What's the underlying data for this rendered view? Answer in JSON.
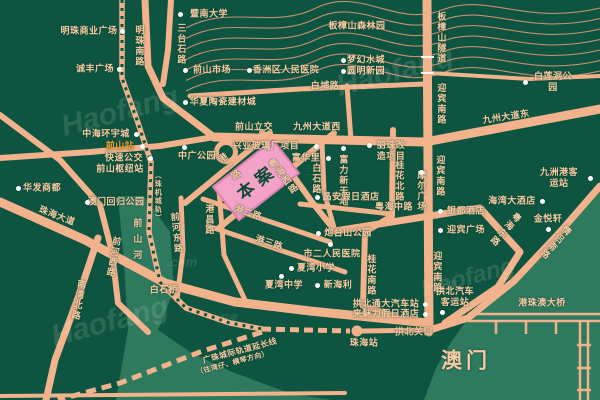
{
  "map": {
    "type": "real-estate-location-map",
    "project_label": "本案",
    "colors": {
      "background": "#0D5540",
      "water": "#2E7A5F",
      "road": "#F2B28C",
      "contour": "#E6987A",
      "label_text": "#F8CBA4",
      "poi_dot": "#FFFFFF",
      "project_pink": "#F3A3C7",
      "station_orange": "#F5A02A"
    },
    "pois": [
      {
        "t": "暨南大学",
        "x": 209,
        "y": 14,
        "d": [
          180,
          14
        ]
      },
      {
        "t": "明珠商业广场",
        "x": 89,
        "y": 31,
        "d": [
          122,
          31
        ]
      },
      {
        "t": "诚丰广场",
        "x": 95,
        "y": 69,
        "d": [
          119,
          69
        ]
      },
      {
        "t": "前山市场",
        "x": 212,
        "y": 70,
        "d": [
          185,
          70
        ]
      },
      {
        "t": "香洲区人民医院",
        "x": 286,
        "y": 70,
        "d": [
          249,
          70
        ]
      },
      {
        "t": "梦幻水城",
        "x": 366,
        "y": 60,
        "d": [
          343,
          60
        ]
      },
      {
        "t": "圆明新园",
        "x": 366,
        "y": 71,
        "d": [
          343,
          71
        ]
      },
      {
        "t": "白莲洞公园",
        "x": 553,
        "y": 82,
        "d": [
          525,
          82
        ]
      },
      {
        "t": "华夏陶瓷建材城",
        "x": 223,
        "y": 102,
        "d": [
          185,
          102
        ]
      },
      {
        "t": "中海环宇城",
        "x": 106,
        "y": 134,
        "d": [
          136,
          134
        ]
      },
      {
        "t": "前山站",
        "x": 120,
        "y": 146,
        "d": [
          142,
          146
        ],
        "c": "#F5A02A"
      },
      {
        "t": "快速公交",
        "x": 124,
        "y": 158,
        "d": [
          150,
          158
        ]
      },
      {
        "t": "前山枢纽站",
        "x": 120,
        "y": 169
      },
      {
        "t": "中广公园",
        "x": 197,
        "y": 156,
        "d": [
          184,
          147
        ]
      },
      {
        "t": "华发商都",
        "x": 42,
        "y": 188,
        "d": [
          18,
          188
        ]
      },
      {
        "t": "澳门回归公园",
        "x": 116,
        "y": 202,
        "d": [
          87,
          202
        ]
      },
      {
        "t": "兴业玻璃厂项目",
        "x": 266,
        "y": 146,
        "d": [
          316,
          146
        ]
      },
      {
        "t": "富华里",
        "x": 306,
        "y": 158,
        "d": [
          328,
          158
        ]
      },
      {
        "t": "富力新天地",
        "x": 343,
        "y": 181,
        "d": [
          343,
          148
        ],
        "v": 1
      },
      {
        "t": "丽珠改\n造项目",
        "x": 391,
        "y": 151,
        "d": [
          369,
          145
        ]
      },
      {
        "t": "晶安假日酒店",
        "x": 351,
        "y": 197,
        "d": [
          317,
          197
        ]
      },
      {
        "t": "摩尔广场",
        "x": 421,
        "y": 191,
        "d": [
          421,
          172
        ],
        "v": 1
      },
      {
        "t": "九洲港客运站",
        "x": 559,
        "y": 178,
        "d": [
          590,
          178
        ]
      },
      {
        "t": "炮台山公园",
        "x": 348,
        "y": 233,
        "d": [
          318,
          233
        ]
      },
      {
        "t": "市二人民医院",
        "x": 332,
        "y": 254,
        "d": [
          330,
          244
        ]
      },
      {
        "t": "夏湾小学",
        "x": 316,
        "y": 268,
        "d": [
          291,
          268
        ]
      },
      {
        "t": "夏湾中学",
        "x": 284,
        "y": 285,
        "d": [
          281,
          276
        ]
      },
      {
        "t": "新海利",
        "x": 338,
        "y": 285,
        "d": [
          317,
          285
        ]
      },
      {
        "t": "银都酒店",
        "x": 466,
        "y": 211,
        "d": [
          440,
          211
        ]
      },
      {
        "t": "迎宾广场",
        "x": 466,
        "y": 230,
        "d": [
          440,
          230
        ]
      },
      {
        "t": "海湾大酒店",
        "x": 512,
        "y": 201,
        "d": [
          542,
          201
        ]
      },
      {
        "t": "金悦轩",
        "x": 548,
        "y": 219,
        "d": [
          548,
          229
        ]
      },
      {
        "t": "拱北通大汽车站",
        "x": 386,
        "y": 304,
        "d": [
          425,
          304
        ]
      },
      {
        "t": "来魅力假日酒店",
        "x": 386,
        "y": 314,
        "d": [
          425,
          314
        ]
      },
      {
        "t": "拱北汽车\n客运站",
        "x": 455,
        "y": 297,
        "d": [
          442,
          312
        ]
      }
    ],
    "labels": [
      {
        "t": "明珠南路",
        "x": 139,
        "y": 46,
        "v": 1
      },
      {
        "t": "三台石路",
        "x": 181,
        "y": 44,
        "v": 1
      },
      {
        "t": "板樟山隧道",
        "x": 441,
        "y": 38,
        "v": 1
      },
      {
        "t": "迎宾南路",
        "x": 441,
        "y": 104,
        "v": 1
      },
      {
        "t": "迎宾南路",
        "x": 440,
        "y": 176,
        "v": 1
      },
      {
        "t": "迎宾南路",
        "x": 437,
        "y": 272,
        "v": 1
      },
      {
        "t": "白埔路",
        "x": 325,
        "y": 86
      },
      {
        "t": "前山立交",
        "x": 254,
        "y": 127
      },
      {
        "t": "九州大道西",
        "x": 317,
        "y": 127
      },
      {
        "t": "九州大道东",
        "x": 506,
        "y": 117,
        "rot": -9
      },
      {
        "t": "港一路",
        "x": 229,
        "y": 167,
        "v": 1,
        "rot": -38
      },
      {
        "t": "粤海西路",
        "x": 283,
        "y": 177,
        "v": 1,
        "rot": -38
      },
      {
        "t": "港二路",
        "x": 248,
        "y": 213,
        "rot": 18
      },
      {
        "t": "港三路",
        "x": 269,
        "y": 243,
        "rot": 18
      },
      {
        "t": "港昌路",
        "x": 209,
        "y": 220,
        "v": 1
      },
      {
        "t": "白石路",
        "x": 316,
        "y": 179,
        "v": 1
      },
      {
        "t": "桂花北路",
        "x": 399,
        "y": 181,
        "v": 1
      },
      {
        "t": "桂花南路",
        "x": 371,
        "y": 275,
        "v": 1
      },
      {
        "t": "粤海中路",
        "x": 394,
        "y": 207
      },
      {
        "t": "粤海东路",
        "x": 505,
        "y": 229,
        "v": 1,
        "rot": 42
      },
      {
        "t": "情侣南路",
        "x": 555,
        "y": 242,
        "v": 1,
        "rot": 42
      },
      {
        "t": "珠海大道",
        "x": 57,
        "y": 216,
        "rot": 21
      },
      {
        "t": "南湾北路",
        "x": 78,
        "y": 300,
        "v": 1,
        "rot": 10
      },
      {
        "t": "前河西路",
        "x": 113,
        "y": 257,
        "v": 1,
        "rot": 10
      },
      {
        "t": "前河东路",
        "x": 176,
        "y": 233,
        "v": 1,
        "rot": -6
      },
      {
        "t": "前山河",
        "x": 137,
        "y": 242,
        "v": 1,
        "ls": 7
      },
      {
        "t": "白石桥",
        "x": 164,
        "y": 290
      },
      {
        "t": "板樟山森林园",
        "x": 357,
        "y": 26
      },
      {
        "t": "（珠机城轨）",
        "x": 157,
        "y": 197,
        "v": 1,
        "fs": 7
      },
      {
        "t": "广珠城际轨道延长线",
        "x": 240,
        "y": 351,
        "rot": -15,
        "fs": 8
      },
      {
        "t": "（往湾仔、横琴方向）",
        "x": 233,
        "y": 364,
        "rot": -15,
        "fs": 7
      },
      {
        "t": "港珠澳大桥",
        "x": 542,
        "y": 303
      },
      {
        "t": "拱北关口",
        "x": 414,
        "y": 332
      },
      {
        "t": "珠海站",
        "x": 364,
        "y": 343
      },
      {
        "t": "澳门",
        "x": 466,
        "y": 361,
        "fs": 21,
        "ls": 4
      }
    ],
    "watermarks": [
      {
        "t": "Haofang",
        "x": 120,
        "y": 112,
        "rot": -15,
        "fs": 30
      },
      {
        "t": "Haofang",
        "x": 395,
        "y": 72,
        "rot": -15,
        "fs": 30
      },
      {
        "t": "Haofang",
        "x": 110,
        "y": 322,
        "rot": -15,
        "fs": 30
      },
      {
        "t": "Haofang",
        "x": 468,
        "y": 278,
        "rot": -15,
        "fs": 24
      },
      {
        "t": ".com",
        "x": 182,
        "y": 262,
        "rot": 0,
        "fs": 13
      },
      {
        "t": "好房",
        "x": 447,
        "y": 284,
        "rot": 0,
        "fs": 9
      },
      {
        "t": "好房",
        "x": 228,
        "y": 318,
        "rot": 0,
        "fs": 9
      }
    ]
  }
}
